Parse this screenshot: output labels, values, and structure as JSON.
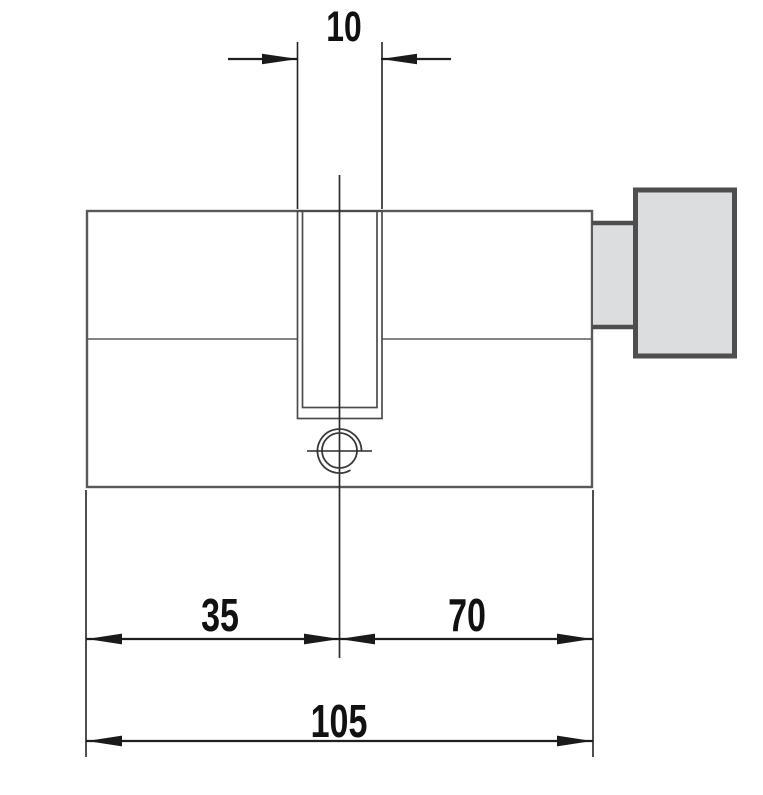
{
  "dimensions": {
    "slot_width": {
      "label": "10"
    },
    "left_section": {
      "label": "35"
    },
    "right_section": {
      "label": "70"
    },
    "overall_length": {
      "label": "105"
    }
  },
  "colors": {
    "background": "#ffffff",
    "part_fill": "#dcddde",
    "part_outline": "#58595b",
    "thumbturn_outline": "#4d4e50",
    "dimension_line": "#1f1f1f",
    "label_text": "#111111"
  }
}
